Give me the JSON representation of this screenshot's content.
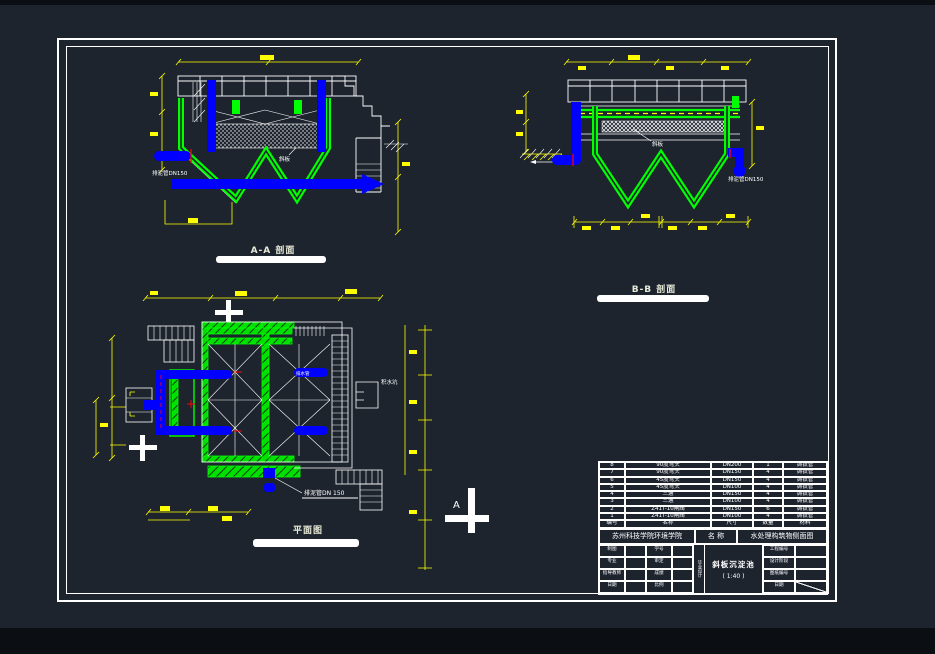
{
  "page": {
    "bg": "#1d242e",
    "sheet_border": "#ffffff"
  },
  "colors": {
    "green": "#00ff00",
    "blue": "#0000ff",
    "yellow": "#ffff00",
    "red": "#ff0000",
    "white": "#ffffff",
    "label": "#e9ead8"
  },
  "views": {
    "section_a": {
      "title": "A-A 剖面",
      "pipe_label": "排泥管DN150",
      "plate_label": "斜板"
    },
    "section_b": {
      "title": "B-B 剖面",
      "pipe_label": "排泥管DN150",
      "plate_label": "斜板"
    },
    "plan": {
      "title": "平面图",
      "pipe_label": "排泥管DN 150",
      "pit_label": "积水坑",
      "drain_label": "排水管"
    },
    "section_marker": {
      "letter": "A"
    }
  },
  "title_block": {
    "parts_table": {
      "headers": [
        "编号",
        "名称",
        "尺寸",
        "数量",
        "材料"
      ],
      "rows": [
        [
          "8",
          "90度弯头",
          "DN200",
          "1",
          "铸铁管"
        ],
        [
          "7",
          "90度弯头",
          "DN150",
          "4",
          "铸铁管"
        ],
        [
          "6",
          "45度弯头",
          "DN150",
          "4",
          "铸铁管"
        ],
        [
          "5",
          "45度弯头",
          "DN100",
          "4",
          "铸铁管"
        ],
        [
          "4",
          "三通",
          "DN150",
          "4",
          "铸铁管"
        ],
        [
          "3",
          "三通",
          "DN100",
          "4",
          "铸铁管"
        ],
        [
          "2",
          "Z41T-10闸阀",
          "DN150",
          "6",
          "铸铁管"
        ],
        [
          "1",
          "Z41T-10闸阀",
          "DN100",
          "4",
          "铸铁管"
        ]
      ]
    },
    "school": "苏州科技学院环境学院",
    "name_label": "名  称",
    "drawing_name": "水处理构筑物侧面图",
    "info_left": [
      [
        "制图",
        "学号"
      ],
      [
        "专业",
        "审定"
      ],
      [
        "指导教师",
        "成绩"
      ],
      [
        "日期",
        "比例"
      ]
    ],
    "vertical_label": "毕业设计",
    "project_title": "斜板沉淀池",
    "scale": "( 1:40 )",
    "info_right": [
      "工程编号",
      "设计阶段",
      "图纸编号",
      "日期"
    ]
  }
}
